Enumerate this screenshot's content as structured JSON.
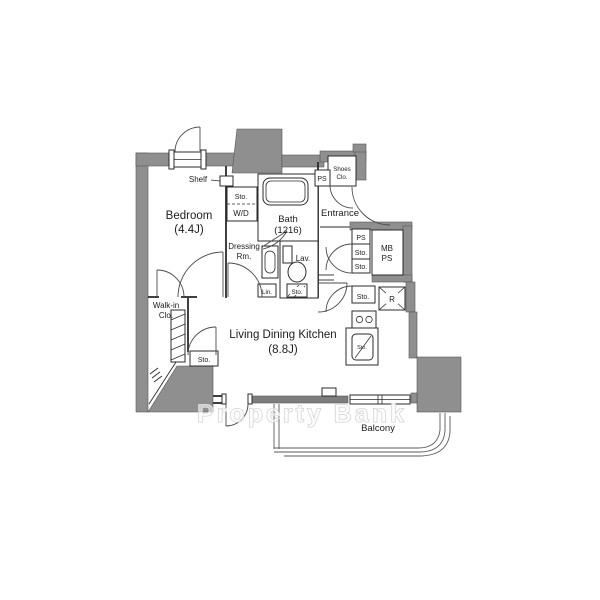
{
  "plan": {
    "type": "apartment-floor-plan",
    "watermark": "Property Bank",
    "rooms": {
      "bedroom": {
        "name": "Bedroom",
        "size": "(4.4J)"
      },
      "ldk": {
        "name": "Living Dining Kitchen",
        "size": "(8.8J)"
      },
      "bath": {
        "name": "Bath",
        "size": "(1216)"
      },
      "entrance": {
        "name": "Entrance"
      },
      "balcony": {
        "name": "Balcony"
      },
      "dressing_room": {
        "line1": "Dressing",
        "line2": "Rm."
      },
      "walk_in_closet": {
        "line1": "Walk-in",
        "line2": "Clo."
      },
      "shoes_closet": {
        "line1": "Shoes",
        "line2": "Clo."
      },
      "lavatory": {
        "name": "Lav."
      }
    },
    "fixtures": {
      "shelf": "Shelf",
      "storage": "Sto.",
      "washer_dryer": "W/D",
      "linen": "Lin.",
      "pipe_space": "PS",
      "meter_box": "MB",
      "refrigerator": "R"
    },
    "colors": {
      "wall_fill": "#8f8f8f",
      "sill_fill": "#7d7d7d",
      "line": "#2b2b2b",
      "watermark_outline": "#cfcfcf",
      "background": "#ffffff"
    }
  }
}
